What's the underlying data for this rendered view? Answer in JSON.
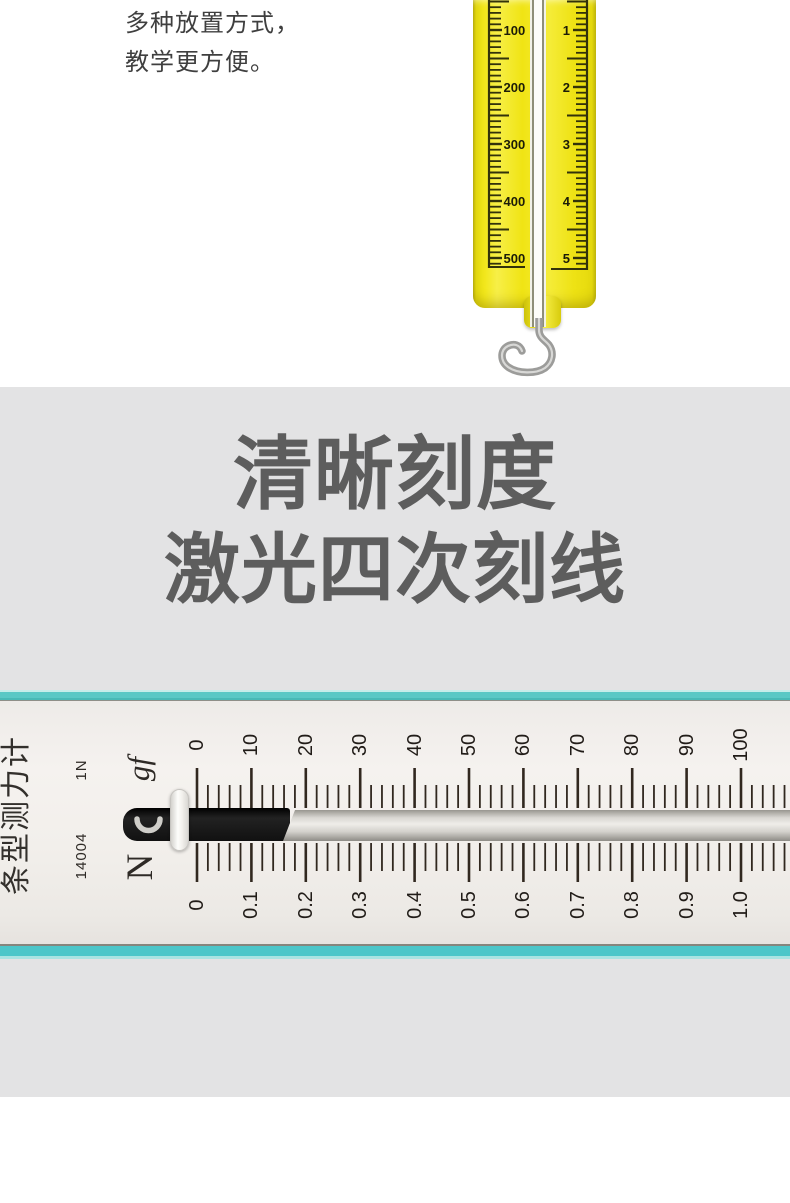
{
  "intro": {
    "line1": "多种放置方式，",
    "line2": "教学更方便。"
  },
  "headline": {
    "line1": "清晰刻度",
    "line2": "激光四次刻线"
  },
  "yellow_scale": {
    "left_labels": [
      "100",
      "200",
      "300",
      "400",
      "500"
    ],
    "right_labels": [
      "1",
      "2",
      "3",
      "4",
      "5"
    ]
  },
  "force_meter": {
    "name": "条型测力计",
    "model": "14004",
    "capacity": "1N",
    "top_unit": "gf",
    "bottom_unit": "N",
    "top_labels": [
      "0",
      "10",
      "20",
      "30",
      "40",
      "50",
      "60",
      "70",
      "80",
      "90",
      "100"
    ],
    "bottom_labels": [
      "0",
      "0.1",
      "0.2",
      "0.3",
      "0.4",
      "0.5",
      "0.6",
      "0.7",
      "0.8",
      "0.9",
      "1.0"
    ]
  },
  "colors": {
    "section_bg": "#e3e3e4",
    "teal_edge": "#54c7c6",
    "scale_yellow": "#f0e414",
    "headline_text": "#5d5d5d",
    "tick_dark": "#31281f",
    "yellow_tick": "#32320a"
  }
}
